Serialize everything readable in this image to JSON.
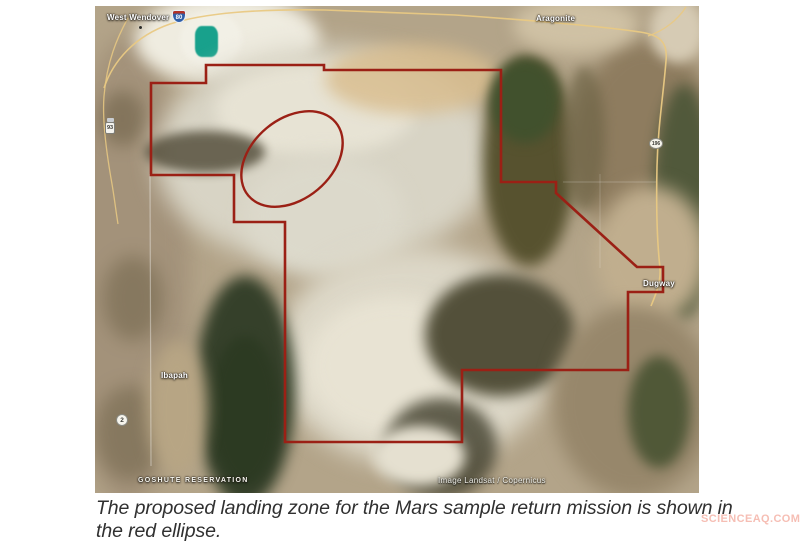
{
  "figure": {
    "caption": "The proposed landing zone for the Mars sample return mission is shown in the red ellipse.",
    "watermark": "SCIENCEAQ.COM"
  },
  "map": {
    "attribution": "Image Landsat / Copernicus",
    "labels": {
      "west_wendover": "West Wendover",
      "aragonite": "Aragonite",
      "dugway": "Dugway",
      "ibapah": "Ibapah",
      "goshute_reservation": "GOSHUTE RESERVATION"
    },
    "route_shields": {
      "interstate_80": "80",
      "state_route_196": "196",
      "state_route_2": "2",
      "us_93": "93"
    },
    "overlay": {
      "boundary_color": "#9b2015",
      "landing_ellipse_color": "#9b2015",
      "road_color": "#e9c983",
      "pond_color": "#18a18c"
    }
  }
}
